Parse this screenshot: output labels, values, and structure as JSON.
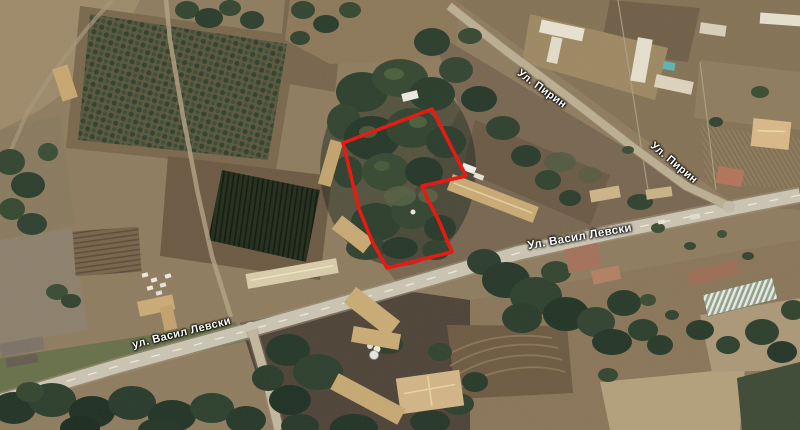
{
  "map": {
    "street_labels": [
      {
        "id": "pirin-top",
        "text": "Ул. Пирин"
      },
      {
        "id": "pirin-right",
        "text": "Ул. Пирин"
      },
      {
        "id": "vasil-levski-main",
        "text": "Ул. Васил Левски"
      },
      {
        "id": "vasil-levski-west",
        "text": "ул. Васил Левски"
      }
    ],
    "parcel_outline": {
      "color": "#e8150c",
      "points": "343,143 432,109 466,176 422,186 429,202 438,219 452,252 387,268 372,241 359,209 351,176"
    },
    "colors": {
      "terrain_base": "#8f7c5f",
      "road_surface": "#cbc4b2",
      "trees_dark": "#2c3e2c",
      "orchard_green": "#2f422d"
    }
  }
}
